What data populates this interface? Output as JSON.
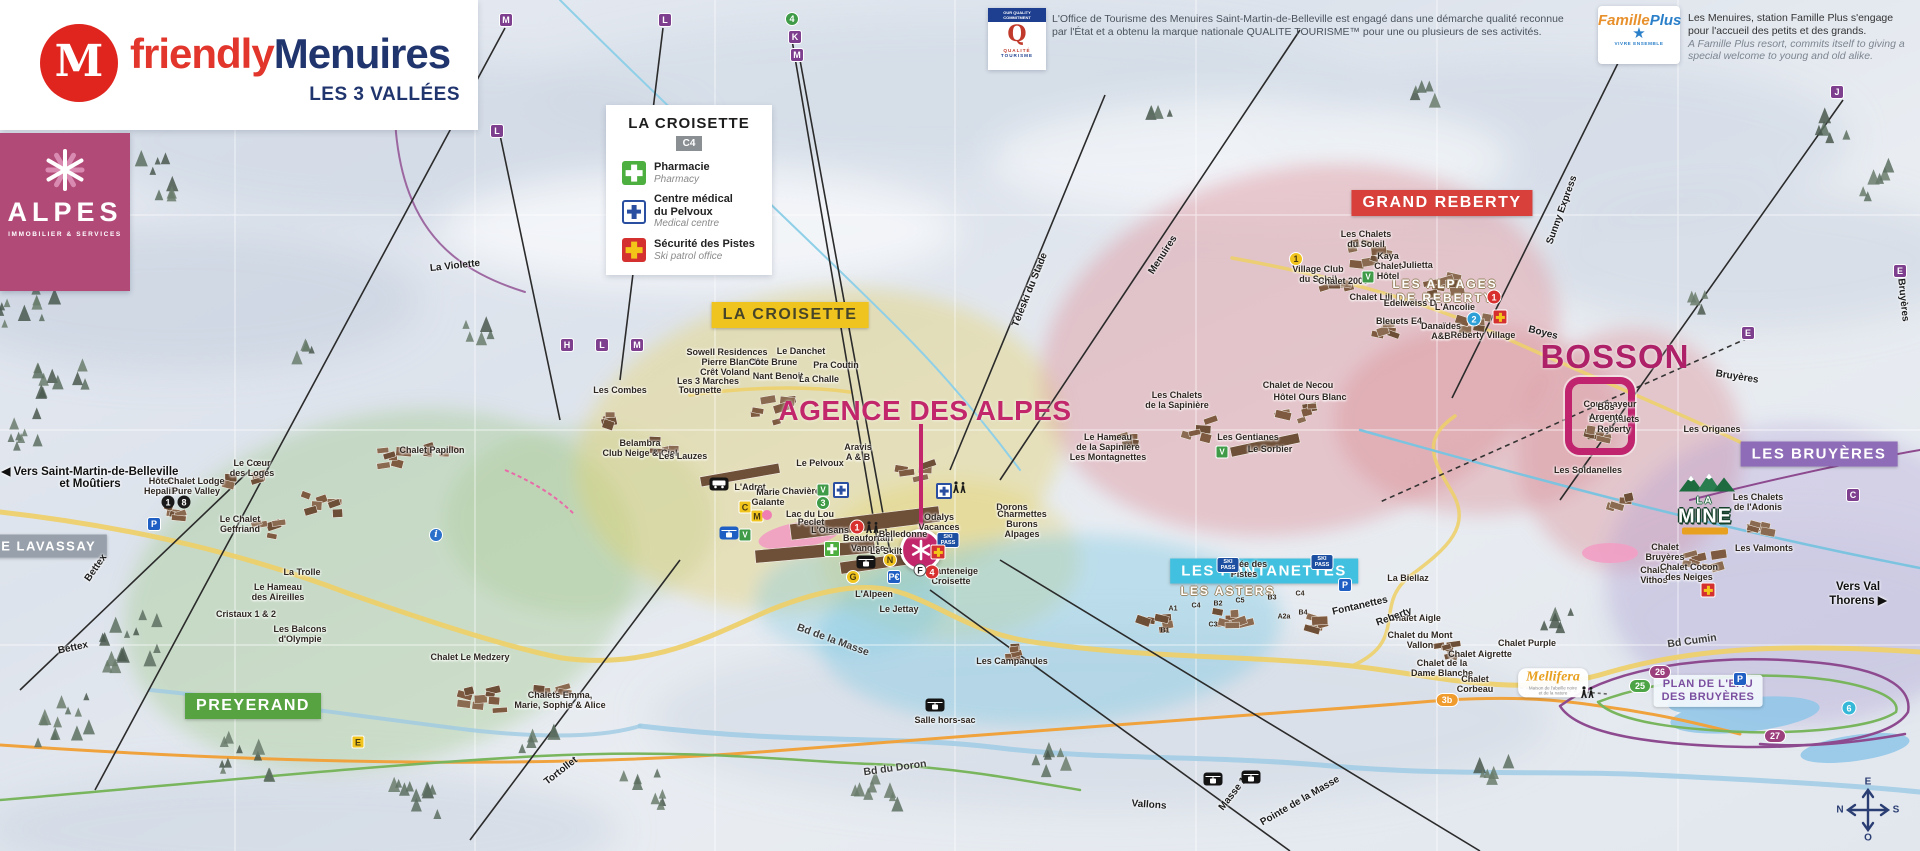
{
  "branding": {
    "logo_letter": "M",
    "brand_part1": "friendly",
    "brand_part2": "Menuires",
    "tagline": "LES 3 VALLÉES",
    "agency_name": "ALPES",
    "agency_sub": "IMMOBILIER & SERVICES"
  },
  "legend": {
    "title": "LA CROISETTE",
    "grid_ref": "C4",
    "items": [
      {
        "icon": "pharmacy-cross",
        "fr": "Pharmacie",
        "en": "Pharmacy"
      },
      {
        "icon": "medical-cross",
        "fr": "Centre médical\ndu Pelvoux",
        "en": "Medical centre"
      },
      {
        "icon": "ski-patrol-cross",
        "fr": "Sécurité des Pistes",
        "en": "Ski patrol office"
      }
    ]
  },
  "quality_tourisme": {
    "badge_top": "OUR QUALITY COMMITMENT",
    "badge_glyph": "Q",
    "badge_name_1": "QUALITÉ",
    "badge_name_2": "TOURISME",
    "text": "L'Office de Tourisme des Menuires Saint-Martin-de-Belleville est engagé dans une démarche qualité reconnue par l'État et a obtenu la marque nationale QUALITE TOURISME™ pour une ou plusieurs de ses activités."
  },
  "famille_plus": {
    "logo_part1": "Famille",
    "logo_part2": "Plus",
    "logo_star": "★",
    "logo_sub": "VIVRE ENSEMBLE",
    "text_fr": "Les Menuires, station Famille Plus s'engage pour l'accueil des petits et des grands.",
    "text_en": "A Famille Plus resort, commits itself to giving a special welcome to young and old alike."
  },
  "agence_label": "AGENCE DES ALPES",
  "bosson_label": "BOSSON",
  "la_mine": {
    "line1": "LA",
    "line2": "MINE"
  },
  "mellifera": {
    "name": "Mellifera",
    "sub": "Maison de l'abeille noire\net de la nature"
  },
  "plan_eau": "PLAN DE L'EAU\nDES BRUYÈRES",
  "compass": {
    "top": "E",
    "right": "S",
    "bottom": "O",
    "left": "N"
  },
  "regions": [
    {
      "id": "la-croisette",
      "label": "LA CROISETTE",
      "x": 790,
      "y": 315,
      "bg": "#f0c41e",
      "fg": "#46452a",
      "fs": 16
    },
    {
      "id": "grand-reberty",
      "label": "GRAND REBERTY",
      "x": 1442,
      "y": 203,
      "bg": "#d8403c",
      "fg": "#ffffff",
      "fs": 16
    },
    {
      "id": "les-fontanettes",
      "label": "LES FONTANETTES",
      "x": 1264,
      "y": 571,
      "bg": "#41c0df",
      "fg": "#ffffff",
      "fs": 15
    },
    {
      "id": "preyerand",
      "label": "PREYERAND",
      "x": 253,
      "y": 706,
      "bg": "#57a342",
      "fg": "#ffffff",
      "fs": 16
    },
    {
      "id": "les-bruyeres",
      "label": "LES BRUYÈRES",
      "x": 1819,
      "y": 454,
      "bg": "#8e6cb8",
      "fg": "#ffffff",
      "fs": 15
    },
    {
      "id": "le-lavassay",
      "label": "LE LAVASSAY",
      "x": 44,
      "y": 546,
      "bg": "#97a0ab",
      "fg": "#ffffff",
      "fs": 13
    }
  ],
  "map_labels": [
    {
      "t": "◀ Vers Saint-Martin-de-Belleville\net Moûtiers",
      "x": 90,
      "y": 477,
      "k": "dir"
    },
    {
      "t": "Vers Val Thorens ▶",
      "x": 1858,
      "y": 594,
      "k": "dir"
    },
    {
      "t": "Hôtel\nHepalik",
      "x": 160,
      "y": 486
    },
    {
      "t": "Chalet Lodge\nPure Valley",
      "x": 196,
      "y": 486
    },
    {
      "t": "Le Cœur\ndes Loges",
      "x": 252,
      "y": 468
    },
    {
      "t": "Le Chalet\nGeffriand",
      "x": 240,
      "y": 524
    },
    {
      "t": "La Trolle",
      "x": 302,
      "y": 572
    },
    {
      "t": "Le Hameau\ndes Aireilles",
      "x": 278,
      "y": 592
    },
    {
      "t": "Cristaux 1 & 2",
      "x": 246,
      "y": 614
    },
    {
      "t": "Les Balcons\nd'Olympie",
      "x": 300,
      "y": 634
    },
    {
      "t": "Chalet Le Medzery",
      "x": 470,
      "y": 657
    },
    {
      "t": "Chalets Emma,\nMarie, Sophie & Alice",
      "x": 560,
      "y": 700
    },
    {
      "t": "Chalet Papillon",
      "x": 432,
      "y": 450
    },
    {
      "t": "Les Combes",
      "x": 620,
      "y": 390
    },
    {
      "t": "Belambra\nClub Neige & Ciel",
      "x": 640,
      "y": 448
    },
    {
      "t": "Les Lauzes",
      "x": 683,
      "y": 456
    },
    {
      "t": "Sowell Residences",
      "x": 727,
      "y": 352
    },
    {
      "t": "Pierre Blanche",
      "x": 733,
      "y": 362
    },
    {
      "t": "Crêt Voland",
      "x": 725,
      "y": 372
    },
    {
      "t": "Les 3 Marches",
      "x": 708,
      "y": 381
    },
    {
      "t": "Tougnette",
      "x": 700,
      "y": 390
    },
    {
      "t": "Côte Brune",
      "x": 773,
      "y": 362
    },
    {
      "t": "Nant Benoit",
      "x": 778,
      "y": 376
    },
    {
      "t": "Le Danchet",
      "x": 801,
      "y": 351
    },
    {
      "t": "La Challe",
      "x": 819,
      "y": 379
    },
    {
      "t": "Pra Coutin",
      "x": 836,
      "y": 365
    },
    {
      "t": "Le Pelvoux",
      "x": 820,
      "y": 463
    },
    {
      "t": "Aravis\nA & B",
      "x": 858,
      "y": 452
    },
    {
      "t": "L'Adret",
      "x": 750,
      "y": 487
    },
    {
      "t": "Marie\nGalante",
      "x": 768,
      "y": 497
    },
    {
      "t": "Chavière",
      "x": 801,
      "y": 491
    },
    {
      "t": "Lac du Lou",
      "x": 810,
      "y": 514
    },
    {
      "t": "Peclet",
      "x": 811,
      "y": 522
    },
    {
      "t": "L'Oisans",
      "x": 830,
      "y": 530
    },
    {
      "t": "Beaufortain\nVanoise",
      "x": 868,
      "y": 543
    },
    {
      "t": "Le Skilt",
      "x": 886,
      "y": 551
    },
    {
      "t": "Belledonne",
      "x": 903,
      "y": 534
    },
    {
      "t": "Odalys\nVacances",
      "x": 939,
      "y": 522
    },
    {
      "t": "Dorons",
      "x": 1012,
      "y": 507
    },
    {
      "t": "Charmettes\nBurons\nAlpages",
      "x": 1022,
      "y": 524
    },
    {
      "t": "Chanteneige\nCroisette",
      "x": 951,
      "y": 576
    },
    {
      "t": "L'Alpeen",
      "x": 874,
      "y": 594
    },
    {
      "t": "Le Jettay",
      "x": 899,
      "y": 609
    },
    {
      "t": "Les Campanules",
      "x": 1012,
      "y": 661
    },
    {
      "t": "Salle hors-sac",
      "x": 945,
      "y": 720
    },
    {
      "t": "LES ASTERS",
      "x": 1228,
      "y": 591,
      "k": "area"
    },
    {
      "t": "A1",
      "x": 1173,
      "y": 609,
      "k": "code"
    },
    {
      "t": "C4",
      "x": 1196,
      "y": 606,
      "k": "code"
    },
    {
      "t": "B2",
      "x": 1218,
      "y": 604,
      "k": "code"
    },
    {
      "t": "C5",
      "x": 1240,
      "y": 601,
      "k": "code"
    },
    {
      "t": "B3",
      "x": 1272,
      "y": 598,
      "k": "code"
    },
    {
      "t": "C4",
      "x": 1300,
      "y": 594,
      "k": "code"
    },
    {
      "t": "A2a",
      "x": 1284,
      "y": 617,
      "k": "code"
    },
    {
      "t": "B4",
      "x": 1303,
      "y": 613,
      "k": "code"
    },
    {
      "t": "C3",
      "x": 1213,
      "y": 625,
      "k": "code"
    },
    {
      "t": "B1",
      "x": 1165,
      "y": 631,
      "k": "code"
    },
    {
      "t": "LES ALPAGES\nDE REBERTY",
      "x": 1445,
      "y": 291,
      "k": "area"
    },
    {
      "t": "Les Chalets\ndu Soleil",
      "x": 1366,
      "y": 239
    },
    {
      "t": "Village Club\ndu Soleil",
      "x": 1318,
      "y": 274
    },
    {
      "t": "Kaya\nChalet\nHôtel",
      "x": 1388,
      "y": 266
    },
    {
      "t": "Julietta",
      "x": 1417,
      "y": 265
    },
    {
      "t": "Chalet 2000",
      "x": 1343,
      "y": 281
    },
    {
      "t": "Chalet Lili",
      "x": 1371,
      "y": 297
    },
    {
      "t": "Edelweiss D",
      "x": 1410,
      "y": 303
    },
    {
      "t": "L'Ancolie",
      "x": 1455,
      "y": 307
    },
    {
      "t": "Bleuets E4",
      "x": 1399,
      "y": 321
    },
    {
      "t": "Danaïdes\nA&B",
      "x": 1441,
      "y": 331
    },
    {
      "t": "Reberty Village",
      "x": 1483,
      "y": 335
    },
    {
      "t": "Hôtel Ours Blanc",
      "x": 1310,
      "y": 397
    },
    {
      "t": "Chalet de Necou",
      "x": 1298,
      "y": 385
    },
    {
      "t": "Les Chalets\nde la Sapinière",
      "x": 1177,
      "y": 400
    },
    {
      "t": "Le Hameau\nde la Sapinière\nLes Montagnettes",
      "x": 1108,
      "y": 447
    },
    {
      "t": "Courmayeur",
      "x": 1610,
      "y": 404
    },
    {
      "t": "Les Chalets\nReberty",
      "x": 1614,
      "y": 424
    },
    {
      "t": "Bos\nArgenté",
      "x": 1606,
      "y": 412
    },
    {
      "t": "Les Soldanelles",
      "x": 1588,
      "y": 470
    },
    {
      "t": "Les Origanes",
      "x": 1712,
      "y": 429
    },
    {
      "t": "Les Gentianes",
      "x": 1248,
      "y": 437
    },
    {
      "t": "Le Sorbier",
      "x": 1270,
      "y": 449
    },
    {
      "t": "L'Orée des\nPistes",
      "x": 1244,
      "y": 569
    },
    {
      "t": "La Biellaz",
      "x": 1408,
      "y": 578
    },
    {
      "t": "Chalet\nBruyères",
      "x": 1665,
      "y": 552
    },
    {
      "t": "Chalet\nVithos",
      "x": 1654,
      "y": 575
    },
    {
      "t": "Chalet Cocon\ndes Neiges",
      "x": 1689,
      "y": 572
    },
    {
      "t": "Les Chalets\nde l'Adonis",
      "x": 1758,
      "y": 502
    },
    {
      "t": "Les Valmonts",
      "x": 1764,
      "y": 548
    },
    {
      "t": "Chalet Aigle",
      "x": 1415,
      "y": 618
    },
    {
      "t": "Chalet du Mont\nVallon",
      "x": 1420,
      "y": 640
    },
    {
      "t": "Chalet Purple",
      "x": 1527,
      "y": 643
    },
    {
      "t": "Chalet Aigrette",
      "x": 1480,
      "y": 654
    },
    {
      "t": "Chalet de la\nDame Blanche",
      "x": 1442,
      "y": 668
    },
    {
      "t": "Chalet\nCorbeau",
      "x": 1475,
      "y": 684
    },
    {
      "t": "Bettex",
      "x": 96,
      "y": 568,
      "k": "lift",
      "r": -55
    },
    {
      "t": "Bettex",
      "x": 73,
      "y": 648,
      "k": "lift",
      "r": -12
    },
    {
      "t": "La Violette",
      "x": 455,
      "y": 266,
      "k": "lift",
      "r": -6
    },
    {
      "t": "Menuires",
      "x": 1163,
      "y": 255,
      "k": "lift",
      "r": -57
    },
    {
      "t": "Téléski du Stade",
      "x": 1030,
      "y": 290,
      "k": "lift",
      "r": -68
    },
    {
      "t": "Sunny Express",
      "x": 1562,
      "y": 210,
      "k": "lift",
      "r": -70
    },
    {
      "t": "Boyes",
      "x": 1543,
      "y": 333,
      "k": "lift",
      "r": 14
    },
    {
      "t": "Bruyères",
      "x": 1737,
      "y": 377,
      "k": "lift",
      "r": 9
    },
    {
      "t": "Bruyères",
      "x": 1903,
      "y": 300,
      "k": "lift",
      "r": 84
    },
    {
      "t": "Fontanettes",
      "x": 1360,
      "y": 606,
      "k": "lift",
      "r": -13
    },
    {
      "t": "Reberty",
      "x": 1394,
      "y": 617,
      "k": "lift",
      "r": -20
    },
    {
      "t": "Masse 1",
      "x": 1233,
      "y": 794,
      "k": "lift",
      "r": -52
    },
    {
      "t": "Pointe de la Masse",
      "x": 1300,
      "y": 801,
      "k": "lift",
      "r": -30
    },
    {
      "t": "Vallons",
      "x": 1149,
      "y": 805,
      "k": "lift",
      "r": 4
    },
    {
      "t": "Tortollet",
      "x": 561,
      "y": 771,
      "k": "lift",
      "r": -38
    },
    {
      "t": "Bd de la Masse",
      "x": 833,
      "y": 640,
      "k": "road",
      "r": 20
    },
    {
      "t": "Bd du Doron",
      "x": 895,
      "y": 768,
      "k": "road",
      "r": -8
    },
    {
      "t": "Bd Cumin",
      "x": 1692,
      "y": 641,
      "k": "road",
      "r": -8
    }
  ],
  "badges": [
    {
      "k": "purple",
      "t": "M",
      "x": 506,
      "y": 20
    },
    {
      "k": "purple",
      "t": "L",
      "x": 665,
      "y": 20
    },
    {
      "k": "purple",
      "t": "K",
      "x": 795,
      "y": 37
    },
    {
      "k": "purple",
      "t": "M",
      "x": 797,
      "y": 55
    },
    {
      "k": "purple",
      "t": "L",
      "x": 497,
      "y": 131
    },
    {
      "k": "purple",
      "t": "H",
      "x": 567,
      "y": 345
    },
    {
      "k": "purple",
      "t": "L",
      "x": 602,
      "y": 345
    },
    {
      "k": "purple",
      "t": "M",
      "x": 637,
      "y": 345
    },
    {
      "k": "purple",
      "t": "J",
      "x": 1837,
      "y": 92
    },
    {
      "k": "purple",
      "t": "E",
      "x": 1748,
      "y": 333
    },
    {
      "k": "purple",
      "t": "E",
      "x": 1900,
      "y": 271
    },
    {
      "k": "purple",
      "t": "C",
      "x": 1853,
      "y": 495
    },
    {
      "k": "green-circle",
      "t": "4",
      "x": 792,
      "y": 19
    },
    {
      "k": "green-circle",
      "t": "3",
      "x": 823,
      "y": 503
    },
    {
      "k": "yellow-circle",
      "t": "1",
      "x": 1296,
      "y": 259
    },
    {
      "k": "yellow-circle",
      "t": "G",
      "x": 853,
      "y": 577
    },
    {
      "k": "yellow-circle",
      "t": "N",
      "x": 890,
      "y": 560
    },
    {
      "k": "yellow-square",
      "t": "C",
      "x": 745,
      "y": 507
    },
    {
      "k": "yellow-square",
      "t": "M",
      "x": 757,
      "y": 516
    },
    {
      "k": "yellow-square",
      "t": "E",
      "x": 358,
      "y": 742
    },
    {
      "k": "black-circle",
      "t": "1",
      "x": 168,
      "y": 502
    },
    {
      "k": "black-circle",
      "t": "8",
      "x": 184,
      "y": 502
    },
    {
      "k": "red-circle",
      "t": "1",
      "x": 857,
      "y": 527
    },
    {
      "k": "red-circle",
      "t": "1",
      "x": 1494,
      "y": 297
    },
    {
      "k": "red-circle",
      "t": "4",
      "x": 932,
      "y": 572
    },
    {
      "k": "blue-circle",
      "t": "2",
      "x": 1474,
      "y": 319
    },
    {
      "k": "white-circle",
      "t": "F",
      "x": 920,
      "y": 570
    },
    {
      "k": "info",
      "t": "i",
      "x": 436,
      "y": 535
    },
    {
      "k": "pink-dot",
      "t": "",
      "x": 767,
      "y": 515
    },
    {
      "k": "pill-orange",
      "t": "3b",
      "x": 1447,
      "y": 700
    },
    {
      "k": "pill-purple",
      "t": "26",
      "x": 1660,
      "y": 672
    },
    {
      "k": "pill-green",
      "t": "25",
      "x": 1640,
      "y": 686
    },
    {
      "k": "pill-purple",
      "t": "27",
      "x": 1775,
      "y": 736
    },
    {
      "k": "cyan-circle",
      "t": "6",
      "x": 1849,
      "y": 708
    },
    {
      "k": "parking",
      "t": "P",
      "x": 154,
      "y": 524
    },
    {
      "k": "parking",
      "t": "P€",
      "x": 894,
      "y": 577
    },
    {
      "k": "parking",
      "t": "P",
      "x": 1345,
      "y": 585
    },
    {
      "k": "parking",
      "t": "P",
      "x": 1740,
      "y": 679
    },
    {
      "k": "skipass",
      "t": "SKI PASS",
      "x": 948,
      "y": 540
    },
    {
      "k": "skipass",
      "t": "SKI PASS",
      "x": 1228,
      "y": 565
    },
    {
      "k": "skipass",
      "t": "SKI PASS",
      "x": 1322,
      "y": 562
    },
    {
      "k": "green-v",
      "t": "V",
      "x": 823,
      "y": 490
    },
    {
      "k": "green-v",
      "t": "V",
      "x": 745,
      "y": 535
    },
    {
      "k": "green-v",
      "t": "V",
      "x": 1368,
      "y": 277
    },
    {
      "k": "green-v",
      "t": "V",
      "x": 1222,
      "y": 452
    },
    {
      "k": "cross-ph",
      "t": "",
      "x": 832,
      "y": 549
    },
    {
      "k": "cross-med",
      "t": "",
      "x": 841,
      "y": 490
    },
    {
      "k": "cross-med",
      "t": "",
      "x": 944,
      "y": 491
    },
    {
      "k": "cross-patrol",
      "t": "",
      "x": 938,
      "y": 552
    },
    {
      "k": "cross-patrol",
      "t": "",
      "x": 1500,
      "y": 317
    },
    {
      "k": "cross-patrol",
      "t": "",
      "x": 1708,
      "y": 590
    },
    {
      "k": "bus",
      "t": "",
      "x": 719,
      "y": 484
    },
    {
      "k": "gond",
      "t": "",
      "x": 866,
      "y": 562
    },
    {
      "k": "gond",
      "t": "",
      "x": 935,
      "y": 705
    },
    {
      "k": "gond",
      "t": "",
      "x": 1213,
      "y": 779
    },
    {
      "k": "gond",
      "t": "",
      "x": 1251,
      "y": 777
    },
    {
      "k": "gond-blue",
      "t": "",
      "x": 729,
      "y": 533
    },
    {
      "k": "walkers",
      "t": "",
      "x": 959,
      "y": 487
    },
    {
      "k": "walkers",
      "t": "",
      "x": 872,
      "y": 527
    },
    {
      "k": "walkers",
      "t": "",
      "x": 1587,
      "y": 692
    }
  ]
}
